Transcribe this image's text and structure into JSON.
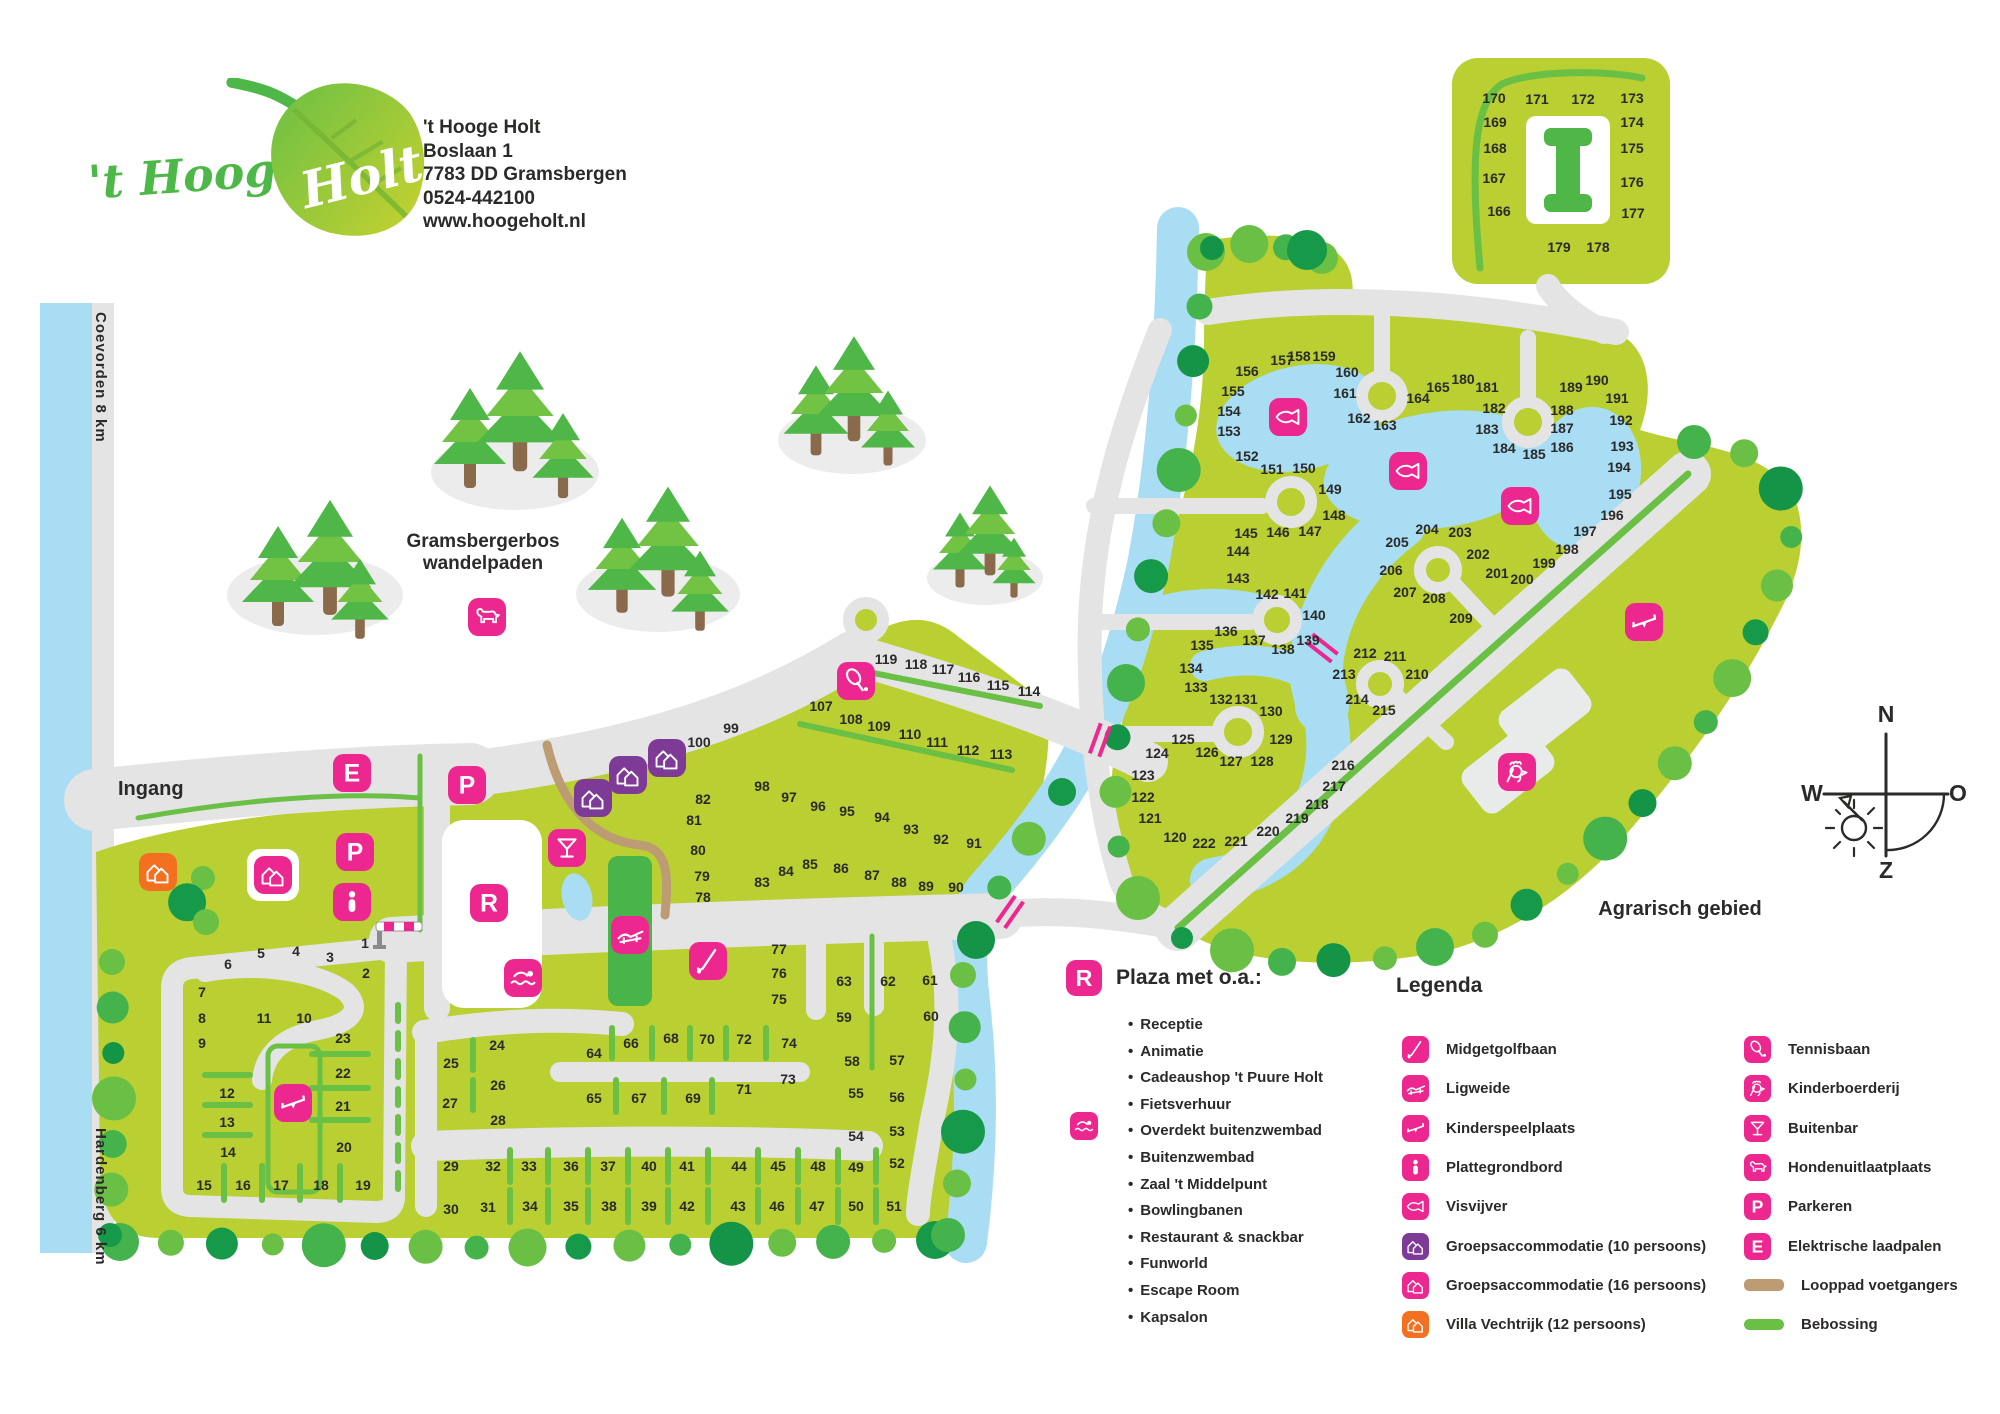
{
  "header": {
    "logo_script": "'t Hooge",
    "logo_leaf": "Holt",
    "address_lines": [
      "'t Hooge Holt",
      "Boslaan 1",
      "7783 DD Gramsbergen",
      "0524-442100",
      "www.hoogeholt.nl"
    ]
  },
  "labels": {
    "ingang": "Ingang",
    "coevorden": "Coevorden 8 km",
    "hardenberg": "Hardenberg 6 km",
    "bos_line1": "Gramsbergerbos",
    "bos_line2": "wandelpaden",
    "agrarisch": "Agrarisch gebied"
  },
  "compass": {
    "n": "N",
    "o": "O",
    "z": "Z",
    "w": "W"
  },
  "colors": {
    "field": "#b9cf32",
    "bright_green": "#6abf45",
    "mid_green": "#45b34c",
    "dark_green": "#169a49",
    "road": "#e4e4e5",
    "water": "#a8ddf3",
    "pink": "#ec2790",
    "purple": "#7d3a96",
    "orange": "#f37021",
    "tan_path": "#bd9c73",
    "text": "#2b2a29"
  },
  "plaza": {
    "icon": "R",
    "title": "Plaza met o.a.:",
    "items": [
      "Receptie",
      "Animatie",
      "Cadeaushop 't Puure Holt",
      "Fietsverhuur",
      "Overdekt buitenzwembad",
      "Buitenzwembad",
      "Zaal 't Middelpunt",
      "Bowlingbanen",
      "Restaurant & snackbar",
      "Funworld",
      "Escape Room",
      "Kapsalon"
    ],
    "side_icon": {
      "type": "swimmer",
      "row": 4
    }
  },
  "legend": {
    "title": "Legenda",
    "left": [
      {
        "icon": "golf",
        "label": "Midgetgolfbaan",
        "color": "#ec2790"
      },
      {
        "icon": "lounger",
        "label": "Ligweide",
        "color": "#ec2790"
      },
      {
        "icon": "seesaw",
        "label": "Kinderspeelplaats",
        "color": "#ec2790"
      },
      {
        "icon": "info",
        "label": "Plattegrondbord",
        "color": "#ec2790"
      },
      {
        "icon": "fish",
        "label": "Visvijver",
        "color": "#ec2790"
      },
      {
        "icon": "houses",
        "label": "Groepsaccommodatie (10 persoons)",
        "color": "#7d3a96"
      },
      {
        "icon": "houses",
        "label": "Groepsaccommodatie (16 persoons)",
        "color": "#ec2790"
      },
      {
        "icon": "houses",
        "label": "Villa Vechtrijk (12 persoons)",
        "color": "#f37021"
      }
    ],
    "right": [
      {
        "icon": "tennis",
        "label": "Tennisbaan",
        "color": "#ec2790"
      },
      {
        "icon": "rooster",
        "label": "Kinderboerderij",
        "color": "#ec2790"
      },
      {
        "icon": "cocktail",
        "label": "Buitenbar",
        "color": "#ec2790"
      },
      {
        "icon": "dog",
        "label": "Hondenuitlaatplaats",
        "color": "#ec2790"
      },
      {
        "icon": "letterP",
        "label": "Parkeren",
        "color": "#ec2790"
      },
      {
        "icon": "letterE",
        "label": "Elektrische laadpalen",
        "color": "#ec2790"
      },
      {
        "icon": "swatch-tan",
        "label": "Looppad voetgangers"
      },
      {
        "icon": "swatch-green",
        "label": "Bebossing"
      }
    ]
  },
  "map": {
    "lots": [
      [
        1,
        365,
        943
      ],
      [
        2,
        366,
        973
      ],
      [
        3,
        330,
        957
      ],
      [
        4,
        296,
        951
      ],
      [
        5,
        261,
        953
      ],
      [
        6,
        228,
        964
      ],
      [
        7,
        202,
        992
      ],
      [
        8,
        202,
        1018
      ],
      [
        9,
        202,
        1043
      ],
      [
        10,
        304,
        1018
      ],
      [
        11,
        264,
        1018
      ],
      [
        12,
        227,
        1093
      ],
      [
        13,
        227,
        1122
      ],
      [
        14,
        228,
        1152
      ],
      [
        15,
        204,
        1185
      ],
      [
        16,
        243,
        1185
      ],
      [
        17,
        281,
        1185
      ],
      [
        18,
        321,
        1185
      ],
      [
        19,
        363,
        1185
      ],
      [
        20,
        344,
        1147
      ],
      [
        21,
        343,
        1106
      ],
      [
        22,
        343,
        1073
      ],
      [
        23,
        343,
        1038
      ],
      [
        24,
        497,
        1045
      ],
      [
        25,
        451,
        1063
      ],
      [
        26,
        498,
        1085
      ],
      [
        27,
        450,
        1103
      ],
      [
        28,
        498,
        1120
      ],
      [
        29,
        451,
        1166
      ],
      [
        30,
        451,
        1209
      ],
      [
        31,
        488,
        1207
      ],
      [
        32,
        493,
        1166
      ],
      [
        33,
        529,
        1166
      ],
      [
        34,
        530,
        1206
      ],
      [
        35,
        571,
        1206
      ],
      [
        36,
        571,
        1166
      ],
      [
        37,
        608,
        1166
      ],
      [
        38,
        609,
        1206
      ],
      [
        39,
        649,
        1206
      ],
      [
        40,
        649,
        1166
      ],
      [
        41,
        687,
        1166
      ],
      [
        42,
        687,
        1206
      ],
      [
        43,
        738,
        1206
      ],
      [
        44,
        739,
        1166
      ],
      [
        45,
        778,
        1166
      ],
      [
        46,
        777,
        1206
      ],
      [
        47,
        817,
        1206
      ],
      [
        48,
        818,
        1166
      ],
      [
        49,
        856,
        1167
      ],
      [
        50,
        856,
        1206
      ],
      [
        51,
        894,
        1206
      ],
      [
        52,
        897,
        1163
      ],
      [
        53,
        897,
        1131
      ],
      [
        54,
        856,
        1136
      ],
      [
        55,
        856,
        1093
      ],
      [
        56,
        897,
        1097
      ],
      [
        57,
        897,
        1060
      ],
      [
        58,
        852,
        1061
      ],
      [
        59,
        844,
        1017
      ],
      [
        60,
        931,
        1016
      ],
      [
        61,
        930,
        980
      ],
      [
        62,
        888,
        981
      ],
      [
        63,
        844,
        981
      ],
      [
        64,
        594,
        1053
      ],
      [
        65,
        594,
        1098
      ],
      [
        66,
        631,
        1043
      ],
      [
        67,
        639,
        1098
      ],
      [
        68,
        671,
        1038
      ],
      [
        69,
        693,
        1098
      ],
      [
        70,
        707,
        1039
      ],
      [
        71,
        744,
        1089
      ],
      [
        72,
        744,
        1039
      ],
      [
        73,
        788,
        1079
      ],
      [
        74,
        789,
        1043
      ],
      [
        75,
        779,
        999
      ],
      [
        76,
        779,
        973
      ],
      [
        77,
        779,
        949
      ],
      [
        78,
        703,
        897
      ],
      [
        79,
        702,
        876
      ],
      [
        80,
        698,
        850
      ],
      [
        81,
        694,
        820
      ],
      [
        82,
        703,
        799
      ],
      [
        83,
        762,
        882
      ],
      [
        84,
        786,
        871
      ],
      [
        85,
        810,
        864
      ],
      [
        86,
        841,
        868
      ],
      [
        87,
        872,
        875
      ],
      [
        88,
        899,
        882
      ],
      [
        89,
        926,
        886
      ],
      [
        90,
        956,
        887
      ],
      [
        91,
        974,
        843
      ],
      [
        92,
        941,
        839
      ],
      [
        93,
        911,
        829
      ],
      [
        94,
        882,
        817
      ],
      [
        95,
        847,
        811
      ],
      [
        96,
        818,
        806
      ],
      [
        97,
        789,
        797
      ],
      [
        98,
        762,
        786
      ],
      [
        99,
        731,
        728
      ],
      [
        100,
        699,
        742
      ],
      [
        107,
        821,
        706
      ],
      [
        108,
        851,
        719
      ],
      [
        109,
        879,
        726
      ],
      [
        110,
        910,
        734
      ],
      [
        111,
        937,
        742
      ],
      [
        112,
        968,
        750
      ],
      [
        113,
        1001,
        754
      ],
      [
        114,
        1029,
        691
      ],
      [
        115,
        998,
        685
      ],
      [
        116,
        969,
        677
      ],
      [
        117,
        943,
        669
      ],
      [
        118,
        916,
        664
      ],
      [
        119,
        886,
        659
      ],
      [
        120,
        1175,
        837
      ],
      [
        121,
        1150,
        818
      ],
      [
        122,
        1143,
        797
      ],
      [
        123,
        1143,
        775
      ],
      [
        124,
        1157,
        753
      ],
      [
        125,
        1183,
        739
      ],
      [
        126,
        1207,
        752
      ],
      [
        127,
        1231,
        761
      ],
      [
        128,
        1262,
        761
      ],
      [
        129,
        1281,
        739
      ],
      [
        130,
        1271,
        711
      ],
      [
        131,
        1246,
        699
      ],
      [
        132,
        1221,
        699
      ],
      [
        133,
        1196,
        687
      ],
      [
        134,
        1191,
        668
      ],
      [
        135,
        1202,
        645
      ],
      [
        136,
        1226,
        631
      ],
      [
        137,
        1254,
        640
      ],
      [
        138,
        1283,
        649
      ],
      [
        139,
        1308,
        640
      ],
      [
        140,
        1314,
        615
      ],
      [
        141,
        1295,
        593
      ],
      [
        142,
        1267,
        594
      ],
      [
        143,
        1238,
        578
      ],
      [
        144,
        1238,
        551
      ],
      [
        145,
        1246,
        533
      ],
      [
        146,
        1278,
        532
      ],
      [
        147,
        1310,
        531
      ],
      [
        148,
        1334,
        515
      ],
      [
        149,
        1330,
        489
      ],
      [
        150,
        1304,
        468
      ],
      [
        151,
        1272,
        469
      ],
      [
        152,
        1247,
        456
      ],
      [
        153,
        1229,
        431
      ],
      [
        154,
        1229,
        411
      ],
      [
        155,
        1233,
        391
      ],
      [
        156,
        1247,
        371
      ],
      [
        157,
        1282,
        360
      ],
      [
        158,
        1299,
        356
      ],
      [
        159,
        1324,
        356
      ],
      [
        160,
        1347,
        372
      ],
      [
        161,
        1345,
        393
      ],
      [
        162,
        1359,
        418
      ],
      [
        163,
        1385,
        425
      ],
      [
        164,
        1418,
        398
      ],
      [
        165,
        1438,
        387
      ],
      [
        166,
        1499,
        211
      ],
      [
        167,
        1494,
        178
      ],
      [
        168,
        1495,
        148
      ],
      [
        169,
        1495,
        122
      ],
      [
        170,
        1494,
        98
      ],
      [
        171,
        1537,
        99
      ],
      [
        172,
        1583,
        99
      ],
      [
        173,
        1632,
        98
      ],
      [
        174,
        1632,
        122
      ],
      [
        175,
        1632,
        148
      ],
      [
        176,
        1632,
        182
      ],
      [
        177,
        1633,
        213
      ],
      [
        178,
        1598,
        247
      ],
      [
        179,
        1559,
        247
      ],
      [
        180,
        1463,
        379
      ],
      [
        181,
        1487,
        387
      ],
      [
        182,
        1494,
        408
      ],
      [
        183,
        1487,
        429
      ],
      [
        184,
        1504,
        448
      ],
      [
        185,
        1534,
        454
      ],
      [
        186,
        1562,
        447
      ],
      [
        187,
        1562,
        428
      ],
      [
        188,
        1562,
        410
      ],
      [
        189,
        1571,
        387
      ],
      [
        190,
        1597,
        380
      ],
      [
        191,
        1617,
        398
      ],
      [
        192,
        1621,
        420
      ],
      [
        193,
        1622,
        446
      ],
      [
        194,
        1619,
        467
      ],
      [
        195,
        1620,
        494
      ],
      [
        196,
        1612,
        515
      ],
      [
        197,
        1585,
        531
      ],
      [
        198,
        1567,
        549
      ],
      [
        199,
        1544,
        563
      ],
      [
        200,
        1522,
        579
      ],
      [
        201,
        1497,
        573
      ],
      [
        202,
        1478,
        554
      ],
      [
        203,
        1460,
        532
      ],
      [
        204,
        1427,
        529
      ],
      [
        205,
        1397,
        542
      ],
      [
        206,
        1391,
        570
      ],
      [
        207,
        1405,
        592
      ],
      [
        208,
        1434,
        598
      ],
      [
        209,
        1461,
        618
      ],
      [
        210,
        1417,
        674
      ],
      [
        211,
        1395,
        656
      ],
      [
        212,
        1365,
        653
      ],
      [
        213,
        1344,
        674
      ],
      [
        214,
        1357,
        699
      ],
      [
        215,
        1384,
        710
      ],
      [
        216,
        1343,
        765
      ],
      [
        217,
        1334,
        786
      ],
      [
        218,
        1317,
        804
      ],
      [
        219,
        1297,
        818
      ],
      [
        220,
        1268,
        831
      ],
      [
        221,
        1236,
        841
      ],
      [
        222,
        1204,
        843
      ]
    ],
    "icons": [
      {
        "type": "letterE",
        "x": 352,
        "y": 773,
        "color": "#ec2790"
      },
      {
        "type": "letterP",
        "x": 467,
        "y": 785,
        "color": "#ec2790"
      },
      {
        "type": "letterP",
        "x": 355,
        "y": 852,
        "color": "#ec2790"
      },
      {
        "type": "info",
        "x": 352,
        "y": 902,
        "color": "#ec2790"
      },
      {
        "type": "letterR",
        "x": 489,
        "y": 903,
        "color": "#ec2790"
      },
      {
        "type": "swimmer",
        "x": 523,
        "y": 978,
        "color": "#ec2790"
      },
      {
        "type": "cocktail",
        "x": 567,
        "y": 848,
        "color": "#ec2790"
      },
      {
        "type": "lounger",
        "x": 630,
        "y": 935,
        "color": "#ec2790"
      },
      {
        "type": "golf",
        "x": 708,
        "y": 961,
        "color": "#ec2790"
      },
      {
        "type": "seesaw",
        "x": 293,
        "y": 1103,
        "color": "#ec2790"
      },
      {
        "type": "seesaw",
        "x": 1644,
        "y": 622,
        "color": "#ec2790"
      },
      {
        "type": "dog",
        "x": 487,
        "y": 617,
        "color": "#ec2790"
      },
      {
        "type": "houses",
        "x": 158,
        "y": 872,
        "color": "#f37021"
      },
      {
        "type": "houses",
        "x": 273,
        "y": 875,
        "color": "#ec2790",
        "plate": true
      },
      {
        "type": "houses",
        "x": 593,
        "y": 798,
        "color": "#7d3a96"
      },
      {
        "type": "houses",
        "x": 628,
        "y": 775,
        "color": "#7d3a96"
      },
      {
        "type": "houses",
        "x": 667,
        "y": 758,
        "color": "#7d3a96"
      },
      {
        "type": "tennis",
        "x": 856,
        "y": 681,
        "color": "#ec2790"
      },
      {
        "type": "fish",
        "x": 1288,
        "y": 417,
        "color": "#ec2790"
      },
      {
        "type": "fish",
        "x": 1408,
        "y": 471,
        "color": "#ec2790"
      },
      {
        "type": "fish",
        "x": 1520,
        "y": 506,
        "color": "#ec2790"
      },
      {
        "type": "rooster",
        "x": 1517,
        "y": 772,
        "color": "#ec2790"
      }
    ]
  }
}
